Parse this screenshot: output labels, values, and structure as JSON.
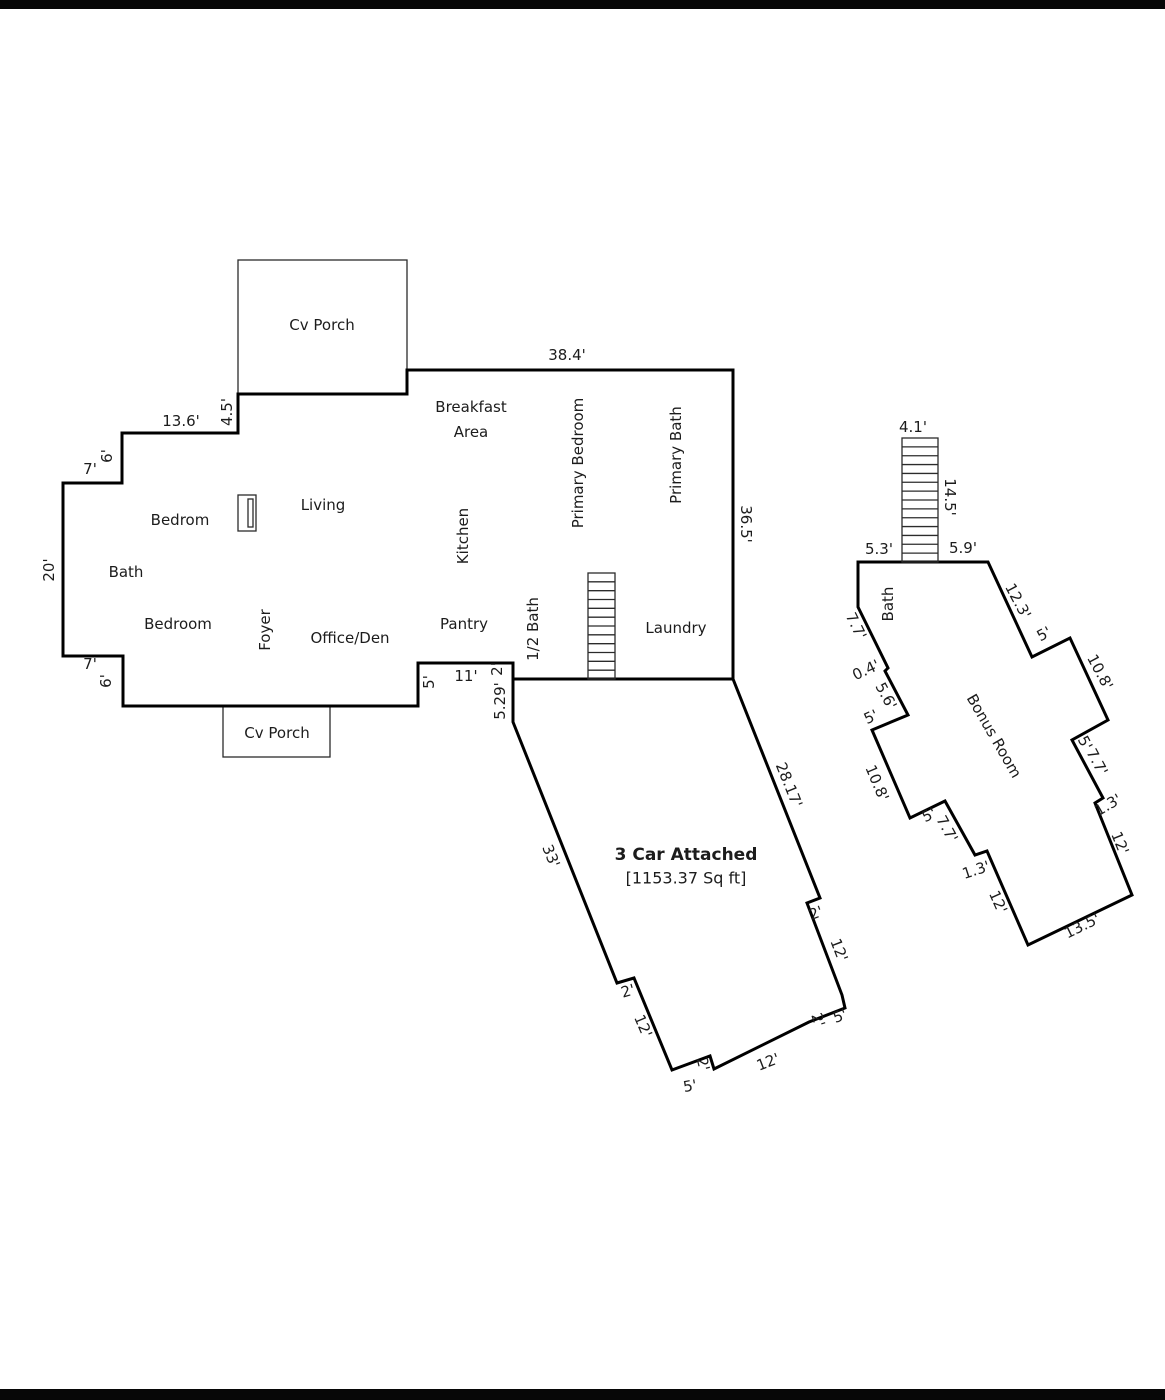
{
  "page": {
    "width": 1165,
    "height": 1400,
    "background": "#ffffff",
    "border_color": "#070707",
    "top_border": {
      "x": 0,
      "y": 0,
      "w": 1165,
      "h": 9
    },
    "bottom_border": {
      "x": 0,
      "y": 1389,
      "w": 1165,
      "h": 11
    }
  },
  "floorplan": {
    "wall_color": "#000000",
    "thin_color": "#2b2b2b",
    "text_color": "#1c1c1c",
    "wall_width": 3,
    "thin_width": 1.3,
    "outlines": {
      "house": "407,370 733,370 733,679 513,679 513,663 418,663 418,706 123,706 123,656 63,656 63,483 122,483 122,433 238,433 238,394 407,394",
      "garage": "513,679 733,679 820,898 807,903 842,995 845,1008 809,1022 714,1069 710,1056 672,1070 634,978 617,983 513,722",
      "bonus_room": "858,562 988,562 1032,657 1070,638 1108,720 1072,740 1103,798 1095,803 1132,895 1028,945 987,851 975,855 945,801 910,818 872,730 908,715 885,671 888,668 858,607"
    },
    "porches": [
      {
        "name": "top-porch",
        "x": 238,
        "y": 260,
        "w": 169,
        "h": 134
      },
      {
        "name": "bottom-porch",
        "x": 223,
        "y": 706,
        "w": 107,
        "h": 51
      }
    ],
    "fireplace": {
      "outer": {
        "x": 238,
        "y": 495,
        "w": 18,
        "h": 36
      },
      "inner": {
        "x": 248,
        "y": 499,
        "w": 5,
        "h": 28
      }
    },
    "stairs": [
      {
        "name": "main-stairs",
        "x": 588,
        "y": 573,
        "w": 27,
        "h": 106,
        "treads": 11
      },
      {
        "name": "bonus-stairs",
        "x": 902,
        "y": 438,
        "w": 36,
        "h": 124,
        "treads": 13
      }
    ],
    "room_labels": [
      {
        "name": "cv-porch-top",
        "text": "Cv Porch",
        "x": 322,
        "y": 325
      },
      {
        "name": "breakfast-line1",
        "text": "Breakfast",
        "x": 471,
        "y": 407
      },
      {
        "name": "breakfast-line2",
        "text": "Area",
        "x": 471,
        "y": 432
      },
      {
        "name": "primary-bedroom",
        "text": "Primary Bedroom",
        "x": 578,
        "y": 463,
        "rotate": -90
      },
      {
        "name": "primary-bath",
        "text": "Primary Bath",
        "x": 676,
        "y": 455,
        "rotate": -90
      },
      {
        "name": "living",
        "text": "Living",
        "x": 323,
        "y": 505
      },
      {
        "name": "kitchen",
        "text": "Kitchen",
        "x": 463,
        "y": 536,
        "rotate": -90
      },
      {
        "name": "bedrom",
        "text": "Bedrom",
        "x": 180,
        "y": 520
      },
      {
        "name": "bath-main",
        "text": "Bath",
        "x": 126,
        "y": 572
      },
      {
        "name": "bedroom",
        "text": "Bedroom",
        "x": 178,
        "y": 624
      },
      {
        "name": "foyer",
        "text": "Foyer",
        "x": 265,
        "y": 630,
        "rotate": -90
      },
      {
        "name": "office-den",
        "text": "Office/Den",
        "x": 350,
        "y": 638
      },
      {
        "name": "pantry",
        "text": "Pantry",
        "x": 464,
        "y": 624
      },
      {
        "name": "half-bath",
        "text": "1/2 Bath",
        "x": 533,
        "y": 629,
        "rotate": -90
      },
      {
        "name": "laundry",
        "text": "Laundry",
        "x": 676,
        "y": 628
      },
      {
        "name": "cv-porch-bottom",
        "text": "Cv Porch",
        "x": 277,
        "y": 733
      },
      {
        "name": "garage-title",
        "text": "3 Car Attached",
        "x": 686,
        "y": 855,
        "bold": true,
        "size": 17
      },
      {
        "name": "garage-sqft",
        "text": "[1153.37 Sq ft]",
        "x": 686,
        "y": 878,
        "size": 16
      },
      {
        "name": "bonus-room",
        "text": "Bonus Room",
        "x": 994,
        "y": 736,
        "rotate": 60
      },
      {
        "name": "bath-bonus",
        "text": "Bath",
        "x": 888,
        "y": 604,
        "rotate": -90
      }
    ],
    "dimension_labels": [
      {
        "text": "38.4'",
        "x": 567,
        "y": 355
      },
      {
        "text": "36.5'",
        "x": 746,
        "y": 524,
        "rotate": 90
      },
      {
        "text": "13.6'",
        "x": 181,
        "y": 421
      },
      {
        "text": "4.5'",
        "x": 227,
        "y": 412,
        "rotate": -90
      },
      {
        "text": "6'",
        "x": 107,
        "y": 456,
        "rotate": -90
      },
      {
        "text": "7'",
        "x": 90,
        "y": 469
      },
      {
        "text": "20'",
        "x": 49,
        "y": 570,
        "rotate": -90
      },
      {
        "text": "7'",
        "x": 90,
        "y": 664
      },
      {
        "text": "6'",
        "x": 106,
        "y": 681,
        "rotate": -90
      },
      {
        "text": "5'",
        "x": 429,
        "y": 682,
        "rotate": -90
      },
      {
        "text": "11'",
        "x": 466,
        "y": 676
      },
      {
        "text": "2'",
        "x": 497,
        "y": 669,
        "rotate": -90
      },
      {
        "text": "5.29'",
        "x": 500,
        "y": 701,
        "rotate": -90
      },
      {
        "text": "33'",
        "x": 551,
        "y": 856,
        "rotate": 68
      },
      {
        "text": "28.17'",
        "x": 789,
        "y": 785,
        "rotate": 68
      },
      {
        "text": "2'",
        "x": 628,
        "y": 991,
        "rotate": -16
      },
      {
        "text": "12'",
        "x": 643,
        "y": 1026,
        "rotate": 67
      },
      {
        "text": "5'",
        "x": 690,
        "y": 1086,
        "rotate": -10
      },
      {
        "text": "2'",
        "x": 703,
        "y": 1064,
        "rotate": 76
      },
      {
        "text": "12'",
        "x": 768,
        "y": 1062,
        "rotate": -21
      },
      {
        "text": "2'",
        "x": 818,
        "y": 1020,
        "rotate": 72
      },
      {
        "text": "5'",
        "x": 840,
        "y": 1016,
        "rotate": -21
      },
      {
        "text": "12'",
        "x": 839,
        "y": 950,
        "rotate": 69
      },
      {
        "text": "2'",
        "x": 816,
        "y": 913,
        "rotate": -21
      },
      {
        "text": "4.1'",
        "x": 913,
        "y": 427
      },
      {
        "text": "14.5'",
        "x": 950,
        "y": 497,
        "rotate": 90
      },
      {
        "text": "5.3'",
        "x": 879,
        "y": 549
      },
      {
        "text": "5.9'",
        "x": 963,
        "y": 548
      },
      {
        "text": "12.3'",
        "x": 1018,
        "y": 601,
        "rotate": 62
      },
      {
        "text": "5'",
        "x": 1044,
        "y": 634,
        "rotate": -28
      },
      {
        "text": "10.8'",
        "x": 1100,
        "y": 672,
        "rotate": 62
      },
      {
        "text": "5'",
        "x": 1085,
        "y": 743,
        "rotate": 62
      },
      {
        "text": "7.7'",
        "x": 1097,
        "y": 762,
        "rotate": 62
      },
      {
        "text": "1.3'",
        "x": 1108,
        "y": 805,
        "rotate": -30
      },
      {
        "text": "12'",
        "x": 1120,
        "y": 843,
        "rotate": 68
      },
      {
        "text": "13.5'",
        "x": 1082,
        "y": 926,
        "rotate": -26
      },
      {
        "text": "7.7'",
        "x": 856,
        "y": 626,
        "rotate": 64
      },
      {
        "text": "0.4'",
        "x": 866,
        "y": 670,
        "rotate": -25
      },
      {
        "text": "5.6'",
        "x": 886,
        "y": 696,
        "rotate": 62
      },
      {
        "text": "5'",
        "x": 871,
        "y": 717,
        "rotate": -25
      },
      {
        "text": "10.8'",
        "x": 877,
        "y": 783,
        "rotate": 67
      },
      {
        "text": "5'",
        "x": 929,
        "y": 815,
        "rotate": -26
      },
      {
        "text": "7.7'",
        "x": 947,
        "y": 829,
        "rotate": 61
      },
      {
        "text": "1.3'",
        "x": 976,
        "y": 870,
        "rotate": -18
      },
      {
        "text": "12'",
        "x": 998,
        "y": 902,
        "rotate": 66
      }
    ]
  }
}
